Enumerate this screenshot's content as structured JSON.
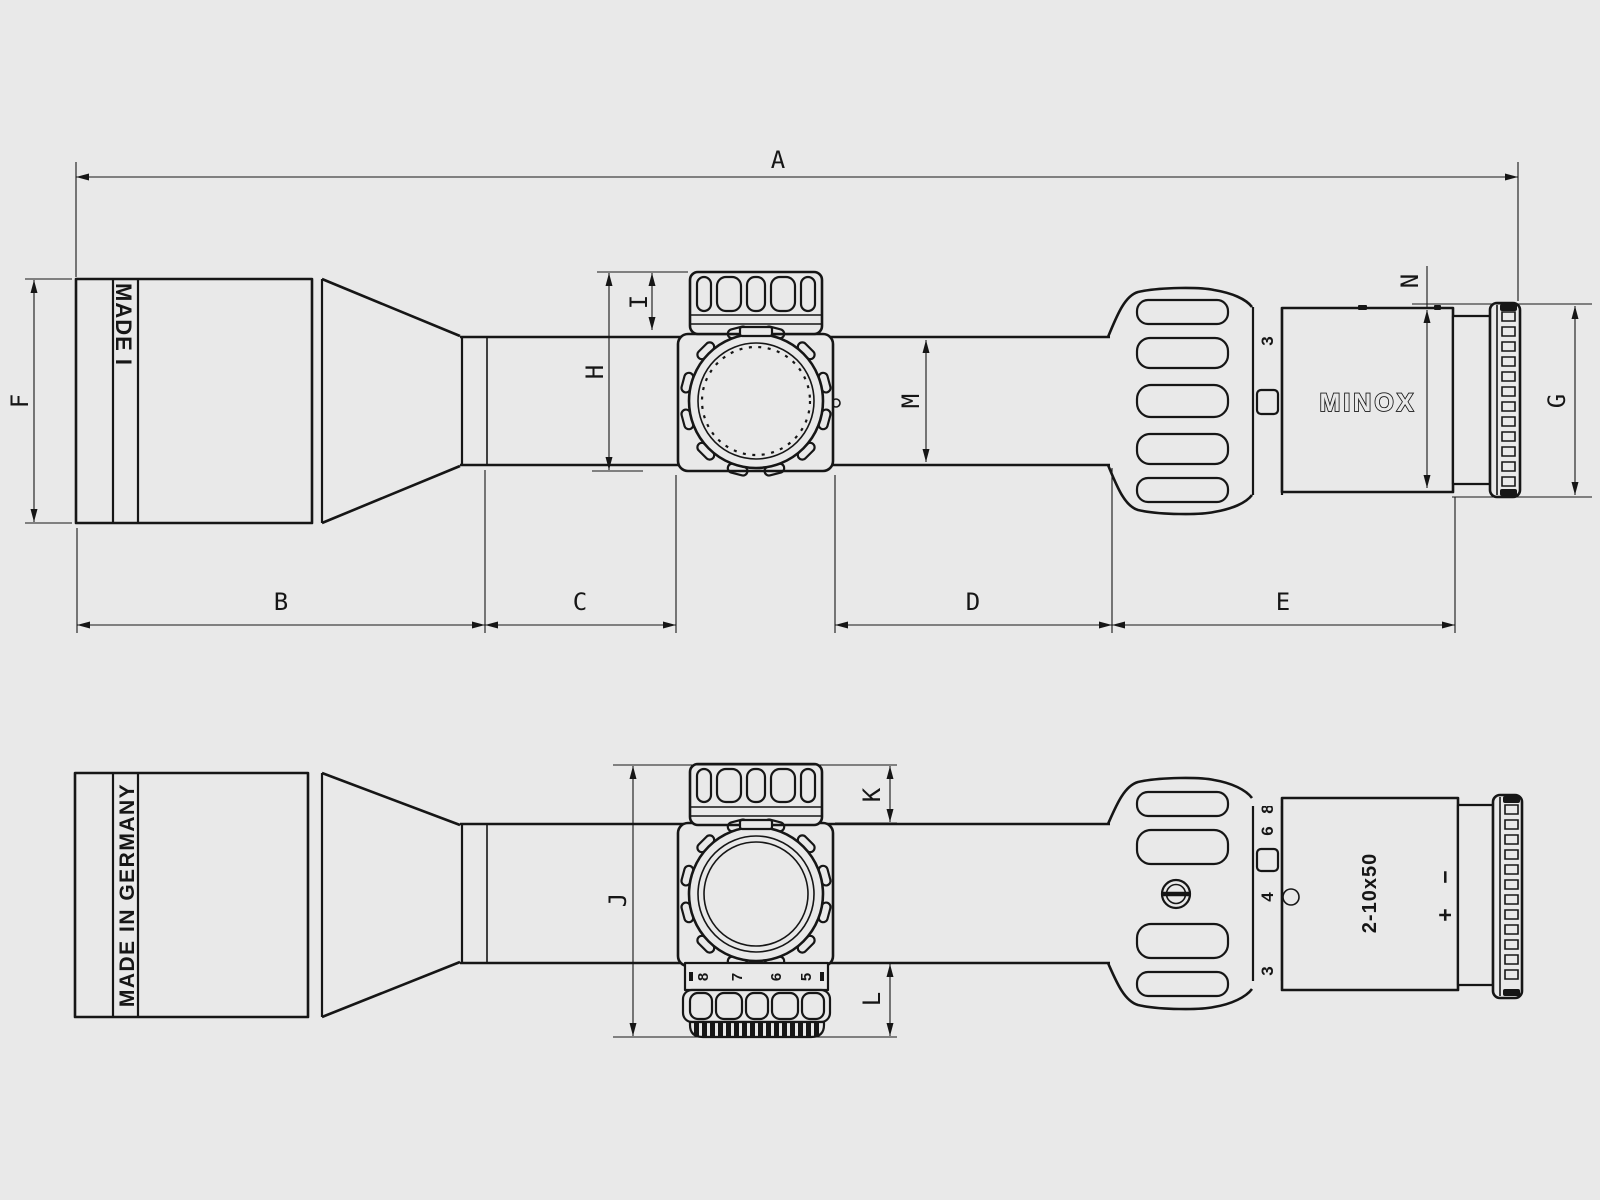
{
  "colors": {
    "background": "#e9e9e9",
    "line": "#161616"
  },
  "dimensions": {
    "a": "A",
    "b": "B",
    "c": "C",
    "d": "D",
    "e": "E",
    "f": "F",
    "g": "G",
    "h": "H",
    "i": "I",
    "j": "J",
    "k": "K",
    "l": "L",
    "m": "M",
    "n": "N"
  },
  "top_view": {
    "objective_print": "MADE I",
    "zoom_ring_number": "3",
    "eyepiece_logo": "MINOX"
  },
  "bottom_view": {
    "objective_print": "MADE IN GERMANY",
    "zoom_ring_numbers": {
      "top_partial": "8",
      "above_index": "6",
      "below_index": "4",
      "bottom": "3"
    },
    "turret_scale_numbers": [
      "8",
      "7",
      "6",
      "5"
    ],
    "eyepiece_model": "2-10x50",
    "diopter_minus": "−",
    "diopter_plus": "+"
  }
}
